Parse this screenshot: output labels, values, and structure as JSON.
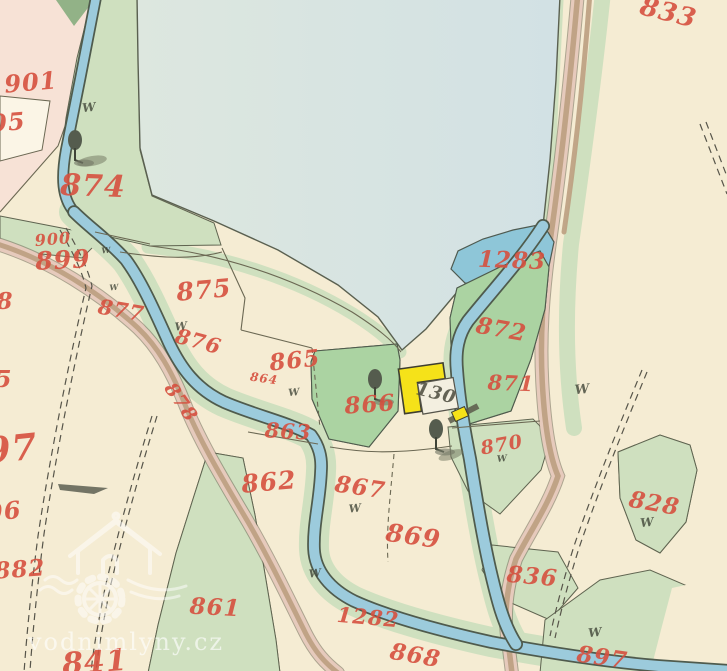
{
  "map": {
    "meadow_mark": "W",
    "watermark": {
      "text": "vodnimlyny.cz"
    },
    "colors": {
      "paper": "#f5ecd3",
      "paper_pink": "#f7e2d6",
      "white_parcel": "#fbf5e6",
      "pond_left": "#dde7df",
      "pond_right": "#d2e1e4",
      "water": "#9ccbdc",
      "pool_water": "#8ec6d8",
      "bank_green": "#cfe0bf",
      "meadow_hatched": "#abd3a2",
      "dark_green": "#92b287",
      "road_pink": "#e6cabc",
      "road_brown": "#bb9e80",
      "ink": "#4b4a3c",
      "label_red": "#d6503f",
      "building_yellow": "#f5e219",
      "courtyard_white": "#f3efe0"
    },
    "region_labels": [
      {
        "t": "833",
        "x": 668,
        "y": 14,
        "s": 26,
        "r": 14
      },
      {
        "t": "901",
        "x": 31,
        "y": 84,
        "s": 24,
        "r": -5
      },
      {
        "t": "05",
        "x": 8,
        "y": 124,
        "s": 24,
        "r": -5
      },
      {
        "t": "874",
        "x": 93,
        "y": 188,
        "s": 30,
        "r": 2
      },
      {
        "t": "900",
        "x": 53,
        "y": 240,
        "s": 16,
        "r": -5
      },
      {
        "t": "899",
        "x": 63,
        "y": 262,
        "s": 25,
        "r": -3
      },
      {
        "t": "877",
        "x": 121,
        "y": 312,
        "s": 21,
        "r": 10
      },
      {
        "t": "875",
        "x": 204,
        "y": 292,
        "s": 25,
        "r": -5
      },
      {
        "t": "876",
        "x": 198,
        "y": 343,
        "s": 21,
        "r": 15
      },
      {
        "t": "878",
        "x": 180,
        "y": 403,
        "s": 19,
        "r": 55
      },
      {
        "t": "865",
        "x": 295,
        "y": 362,
        "s": 23,
        "r": -6
      },
      {
        "t": "864",
        "x": 264,
        "y": 379,
        "s": 12,
        "r": 8
      },
      {
        "t": "866",
        "x": 370,
        "y": 406,
        "s": 23,
        "r": -4
      },
      {
        "t": "863",
        "x": 288,
        "y": 433,
        "s": 21,
        "r": 3
      },
      {
        "t": "862",
        "x": 269,
        "y": 484,
        "s": 25,
        "r": -5
      },
      {
        "t": "867",
        "x": 360,
        "y": 489,
        "s": 23,
        "r": 8
      },
      {
        "t": "869",
        "x": 413,
        "y": 538,
        "s": 25,
        "r": 8
      },
      {
        "t": "861",
        "x": 215,
        "y": 609,
        "s": 23,
        "r": 3
      },
      {
        "t": "882",
        "x": 20,
        "y": 571,
        "s": 23,
        "r": -4
      },
      {
        "t": "97",
        "x": 12,
        "y": 452,
        "s": 36,
        "r": -6
      },
      {
        "t": "96",
        "x": 4,
        "y": 513,
        "s": 24,
        "r": -6
      },
      {
        "t": "8",
        "x": 5,
        "y": 303,
        "s": 23,
        "r": 0
      },
      {
        "t": "5",
        "x": 4,
        "y": 381,
        "s": 23,
        "r": 0
      },
      {
        "t": "841",
        "x": 95,
        "y": 664,
        "s": 30,
        "r": -4
      },
      {
        "t": "1283",
        "x": 512,
        "y": 262,
        "s": 23,
        "r": 2
      },
      {
        "t": "872",
        "x": 501,
        "y": 331,
        "s": 23,
        "r": 10
      },
      {
        "t": "871",
        "x": 511,
        "y": 385,
        "s": 21,
        "r": 2
      },
      {
        "t": "870",
        "x": 502,
        "y": 446,
        "s": 19,
        "r": -10
      },
      {
        "t": "828",
        "x": 654,
        "y": 505,
        "s": 23,
        "r": 10
      },
      {
        "t": "836",
        "x": 532,
        "y": 578,
        "s": 23,
        "r": 5
      },
      {
        "t": "897",
        "x": 602,
        "y": 659,
        "s": 23,
        "r": 8
      },
      {
        "t": "1282",
        "x": 368,
        "y": 619,
        "s": 21,
        "r": 5
      },
      {
        "t": "868",
        "x": 415,
        "y": 657,
        "s": 23,
        "r": 10
      },
      {
        "t": "130",
        "x": 436,
        "y": 394,
        "s": 18,
        "r": 14,
        "c": "ink"
      }
    ],
    "meadow_marks": [
      {
        "x": 89,
        "y": 108,
        "s": 12
      },
      {
        "x": 106,
        "y": 251,
        "s": 8
      },
      {
        "x": 114,
        "y": 288,
        "s": 8
      },
      {
        "x": 181,
        "y": 327,
        "s": 11
      },
      {
        "x": 294,
        "y": 393,
        "s": 10
      },
      {
        "x": 355,
        "y": 509,
        "s": 11
      },
      {
        "x": 315,
        "y": 574,
        "s": 11
      },
      {
        "x": 582,
        "y": 390,
        "s": 13
      },
      {
        "x": 647,
        "y": 523,
        "s": 12
      },
      {
        "x": 595,
        "y": 633,
        "s": 12
      },
      {
        "x": 502,
        "y": 459,
        "s": 9
      }
    ],
    "trees": [
      {
        "x": 75,
        "y": 148
      },
      {
        "x": 375,
        "y": 387
      },
      {
        "x": 436,
        "y": 437
      }
    ]
  }
}
